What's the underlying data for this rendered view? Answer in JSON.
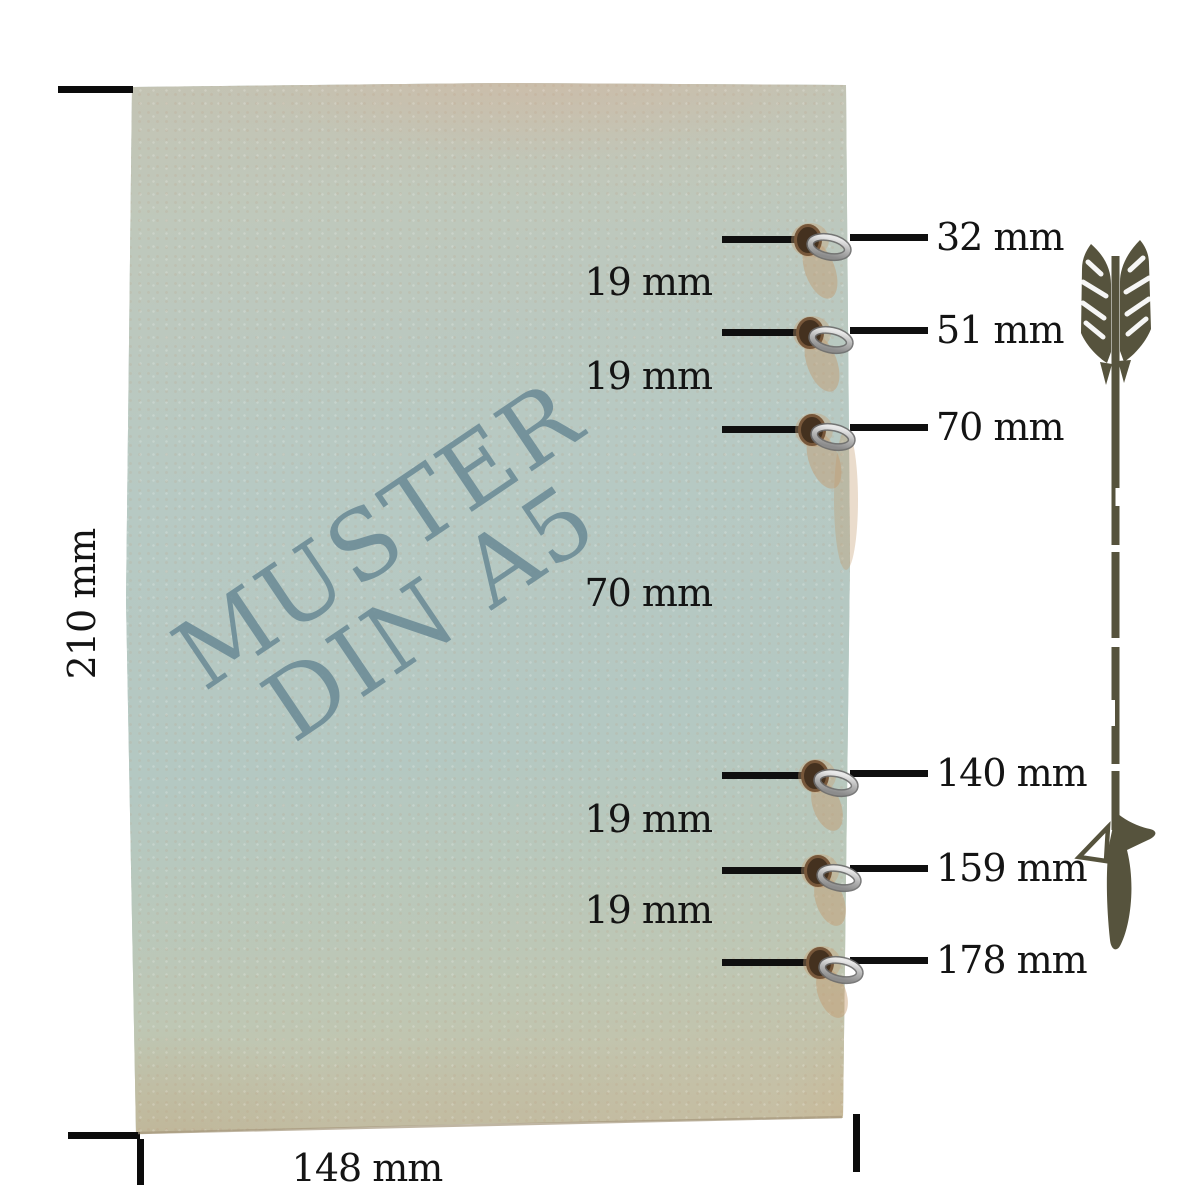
{
  "diagram": {
    "watermark": {
      "line1": "MUSTER",
      "line2": "DIN A5"
    },
    "sheet": {
      "height_label": "210 mm",
      "width_label": "148 mm"
    },
    "hole_labels": [
      {
        "label": "32 mm"
      },
      {
        "label": "51 mm"
      },
      {
        "label": "70 mm"
      },
      {
        "label": "140 mm"
      },
      {
        "label": "159 mm"
      },
      {
        "label": "178 mm"
      }
    ],
    "spacing_labels": [
      {
        "label": "19 mm"
      },
      {
        "label": "19 mm"
      },
      {
        "label": "70 mm"
      },
      {
        "label": "19 mm"
      },
      {
        "label": "19 mm"
      }
    ],
    "colors": {
      "paper_blue": "#b6c9c2",
      "paper_beige_top": "#c6c0ae",
      "paper_tan_bottom": "#cbb795",
      "watermark": "#6888 94",
      "arrow": "#56533d",
      "line": "#0f0f0f",
      "hole": "#44311f",
      "ring_metal": "#b5b5b5"
    }
  }
}
